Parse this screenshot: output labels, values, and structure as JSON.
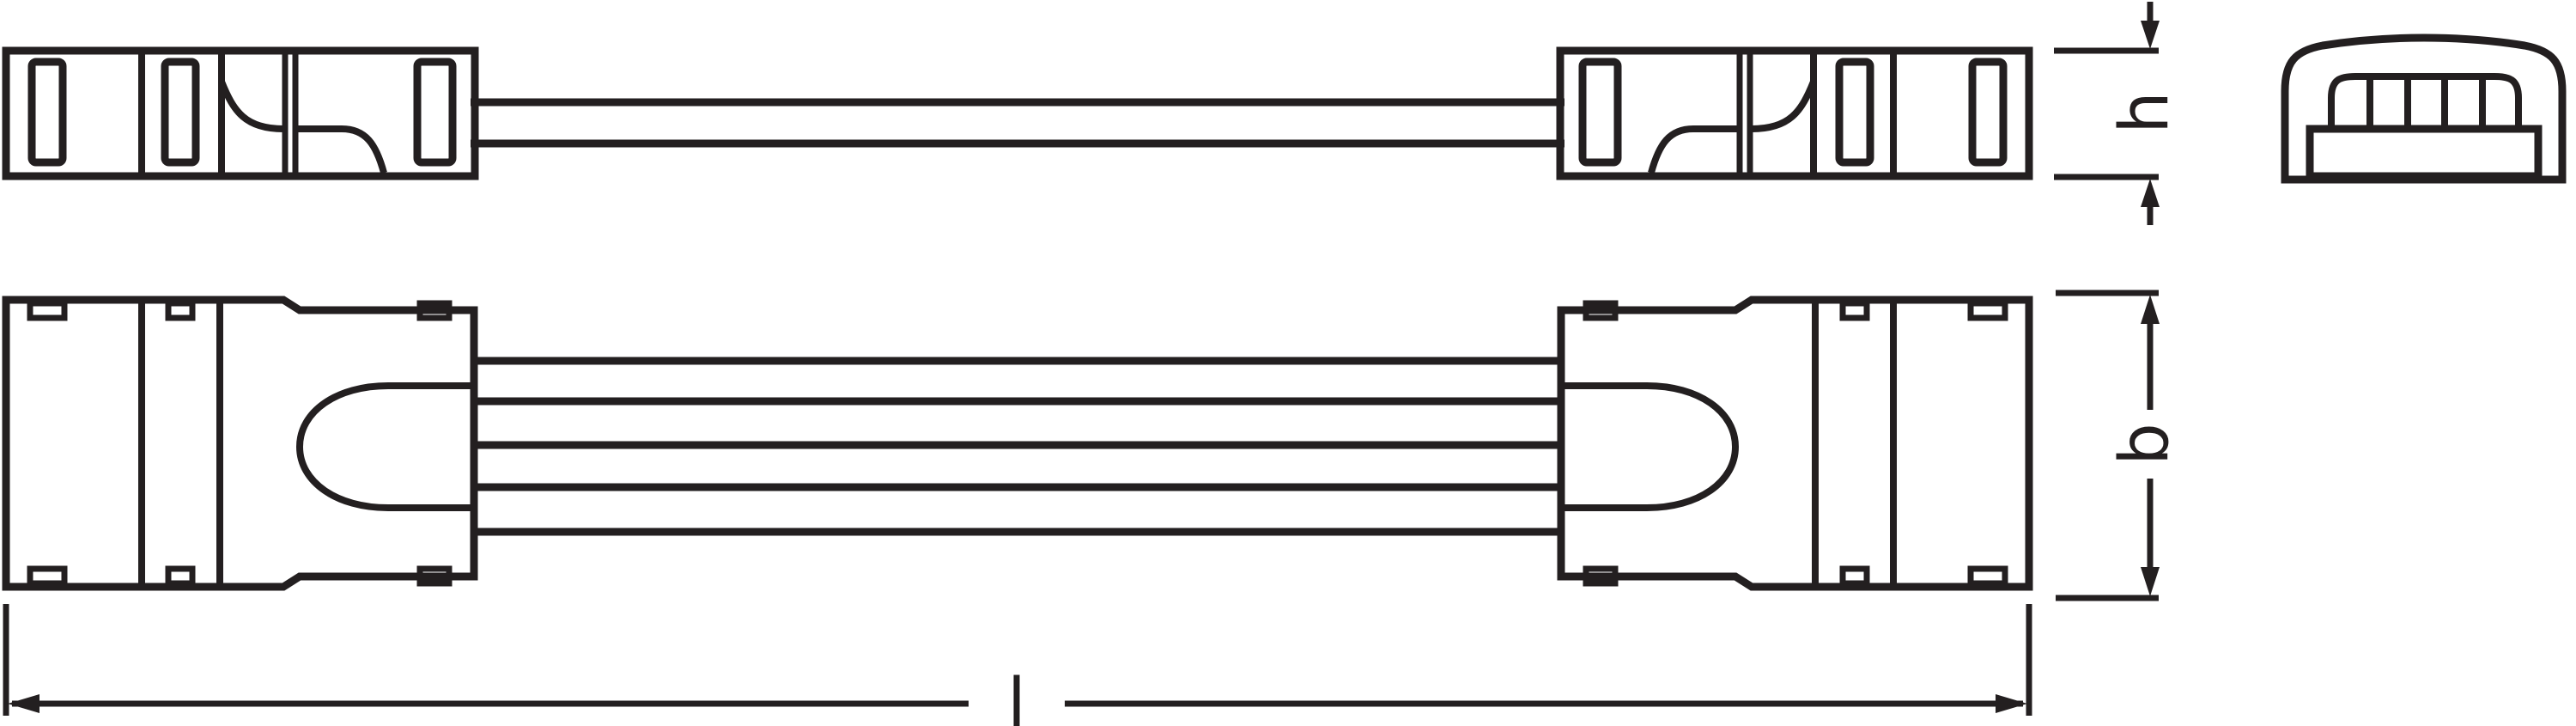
{
  "diagram": {
    "type": "technical-dimension-drawing",
    "subject": "LED strip connector with cable, three orthographic views",
    "stroke_color": "#231f20",
    "background_color": "#ffffff",
    "dimensions": {
      "height_label": "h",
      "width_label": "b",
      "length_label": "l"
    }
  }
}
